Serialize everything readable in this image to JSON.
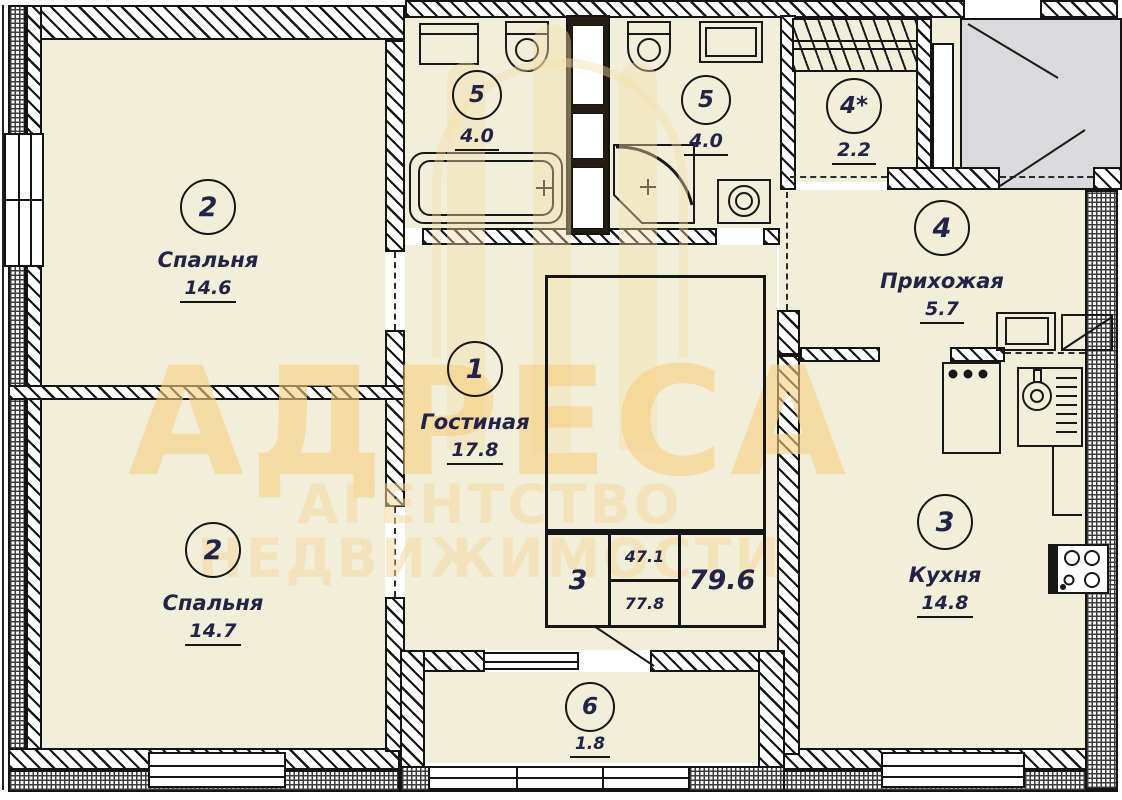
{
  "watermark": {
    "title": "АДРЕСА",
    "subtitle": "АГЕНТСТВО НЕДВИЖИМОСТИ"
  },
  "rooms": {
    "bedroom_top": {
      "number": "2",
      "name": "Спальня",
      "area": "14.6"
    },
    "bedroom_bottom": {
      "number": "2",
      "name": "Спальня",
      "area": "14.7"
    },
    "living": {
      "number": "1",
      "name": "Гостиная",
      "area": "17.8"
    },
    "bath_left": {
      "number": "5",
      "area": "4.0"
    },
    "bath_right": {
      "number": "5",
      "area": "4.0"
    },
    "closet": {
      "number": "4*",
      "area": "2.2"
    },
    "hallway": {
      "number": "4",
      "name": "Прихожая",
      "area": "5.7"
    },
    "kitchen": {
      "number": "3",
      "name": "Кухня",
      "area": "14.8"
    },
    "balcony": {
      "number": "6",
      "area": "1.8"
    }
  },
  "stamp_table": {
    "rooms_count": "3",
    "living_area": "47.1",
    "floor_area": "77.8",
    "total_area": "79.6"
  },
  "colors": {
    "room_fill": "#f1efd9",
    "landing_gray": "#dadadd",
    "watermark_title": "rgba(246,206,128,0.60)",
    "watermark_subtitle": "rgba(245,216,160,0.55)",
    "logo_tint": "rgba(246,222,170,0.42)"
  }
}
